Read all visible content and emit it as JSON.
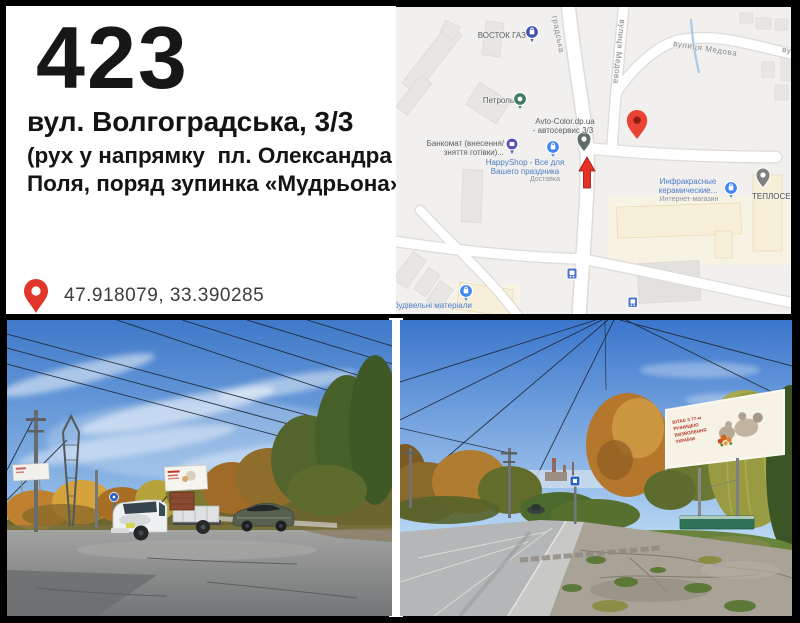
{
  "header": {
    "board_number": "423",
    "address": "вул. Волгоградська, 3/3",
    "direction_note": [
      "(рух у напрямку  пл. Олександра",
      "Поля, поряд зупинка «Мудрьона»)"
    ],
    "coordinates": "47.918079, 33.390285",
    "pin_color": "#e2362b"
  },
  "map": {
    "street_labels": {
      "hradska": "градська",
      "medova_vertical": "вулиця Медова",
      "medova_horizontal": "вулиця Медова",
      "medova_clipped": "ву"
    },
    "pois": {
      "vostok_gaz": {
        "label": "ВОСТОК ГАЗ"
      },
      "petrol": {
        "label": "Петроль"
      },
      "bankomat": {
        "line1": "Банкомат (внесення/",
        "line2": "зняття готівки)..."
      },
      "happyshop": {
        "line1": "HappyShop - Все для",
        "line2": "Вашего праздника",
        "line3": "Доставка"
      },
      "avtocolor": {
        "line1": "Avto-Color.dp.ua",
        "line2": "- автосервис 3/3"
      },
      "infrared": {
        "line1": "Инфракрасные",
        "line2": "керамические...",
        "line3": "Интернет-магазин"
      },
      "teploservice": {
        "label": "ТЕПЛОСЕР"
      },
      "budmaterialy": {
        "label": "будівельні матеріали"
      }
    },
    "colors": {
      "poi_label_blue": "#4d7cc4",
      "poi_label_gray": "#5d6064",
      "street_label_gray": "#8c8c90",
      "marker_navy": "#4353b2",
      "marker_green": "#3f7b5e",
      "marker_purple": "#5a50ba",
      "marker_blue": "#4285f4",
      "destination_pin_red": "#ea4335",
      "direction_arrow_red": "#e73127"
    }
  },
  "photos": {
    "right_billboard_text": [
      "ВІТАЄ З 77-м",
      "РІЧНИЦЕЮ",
      "ВИЗВОЛЕННЯ",
      "УКРАЇНИ"
    ]
  }
}
